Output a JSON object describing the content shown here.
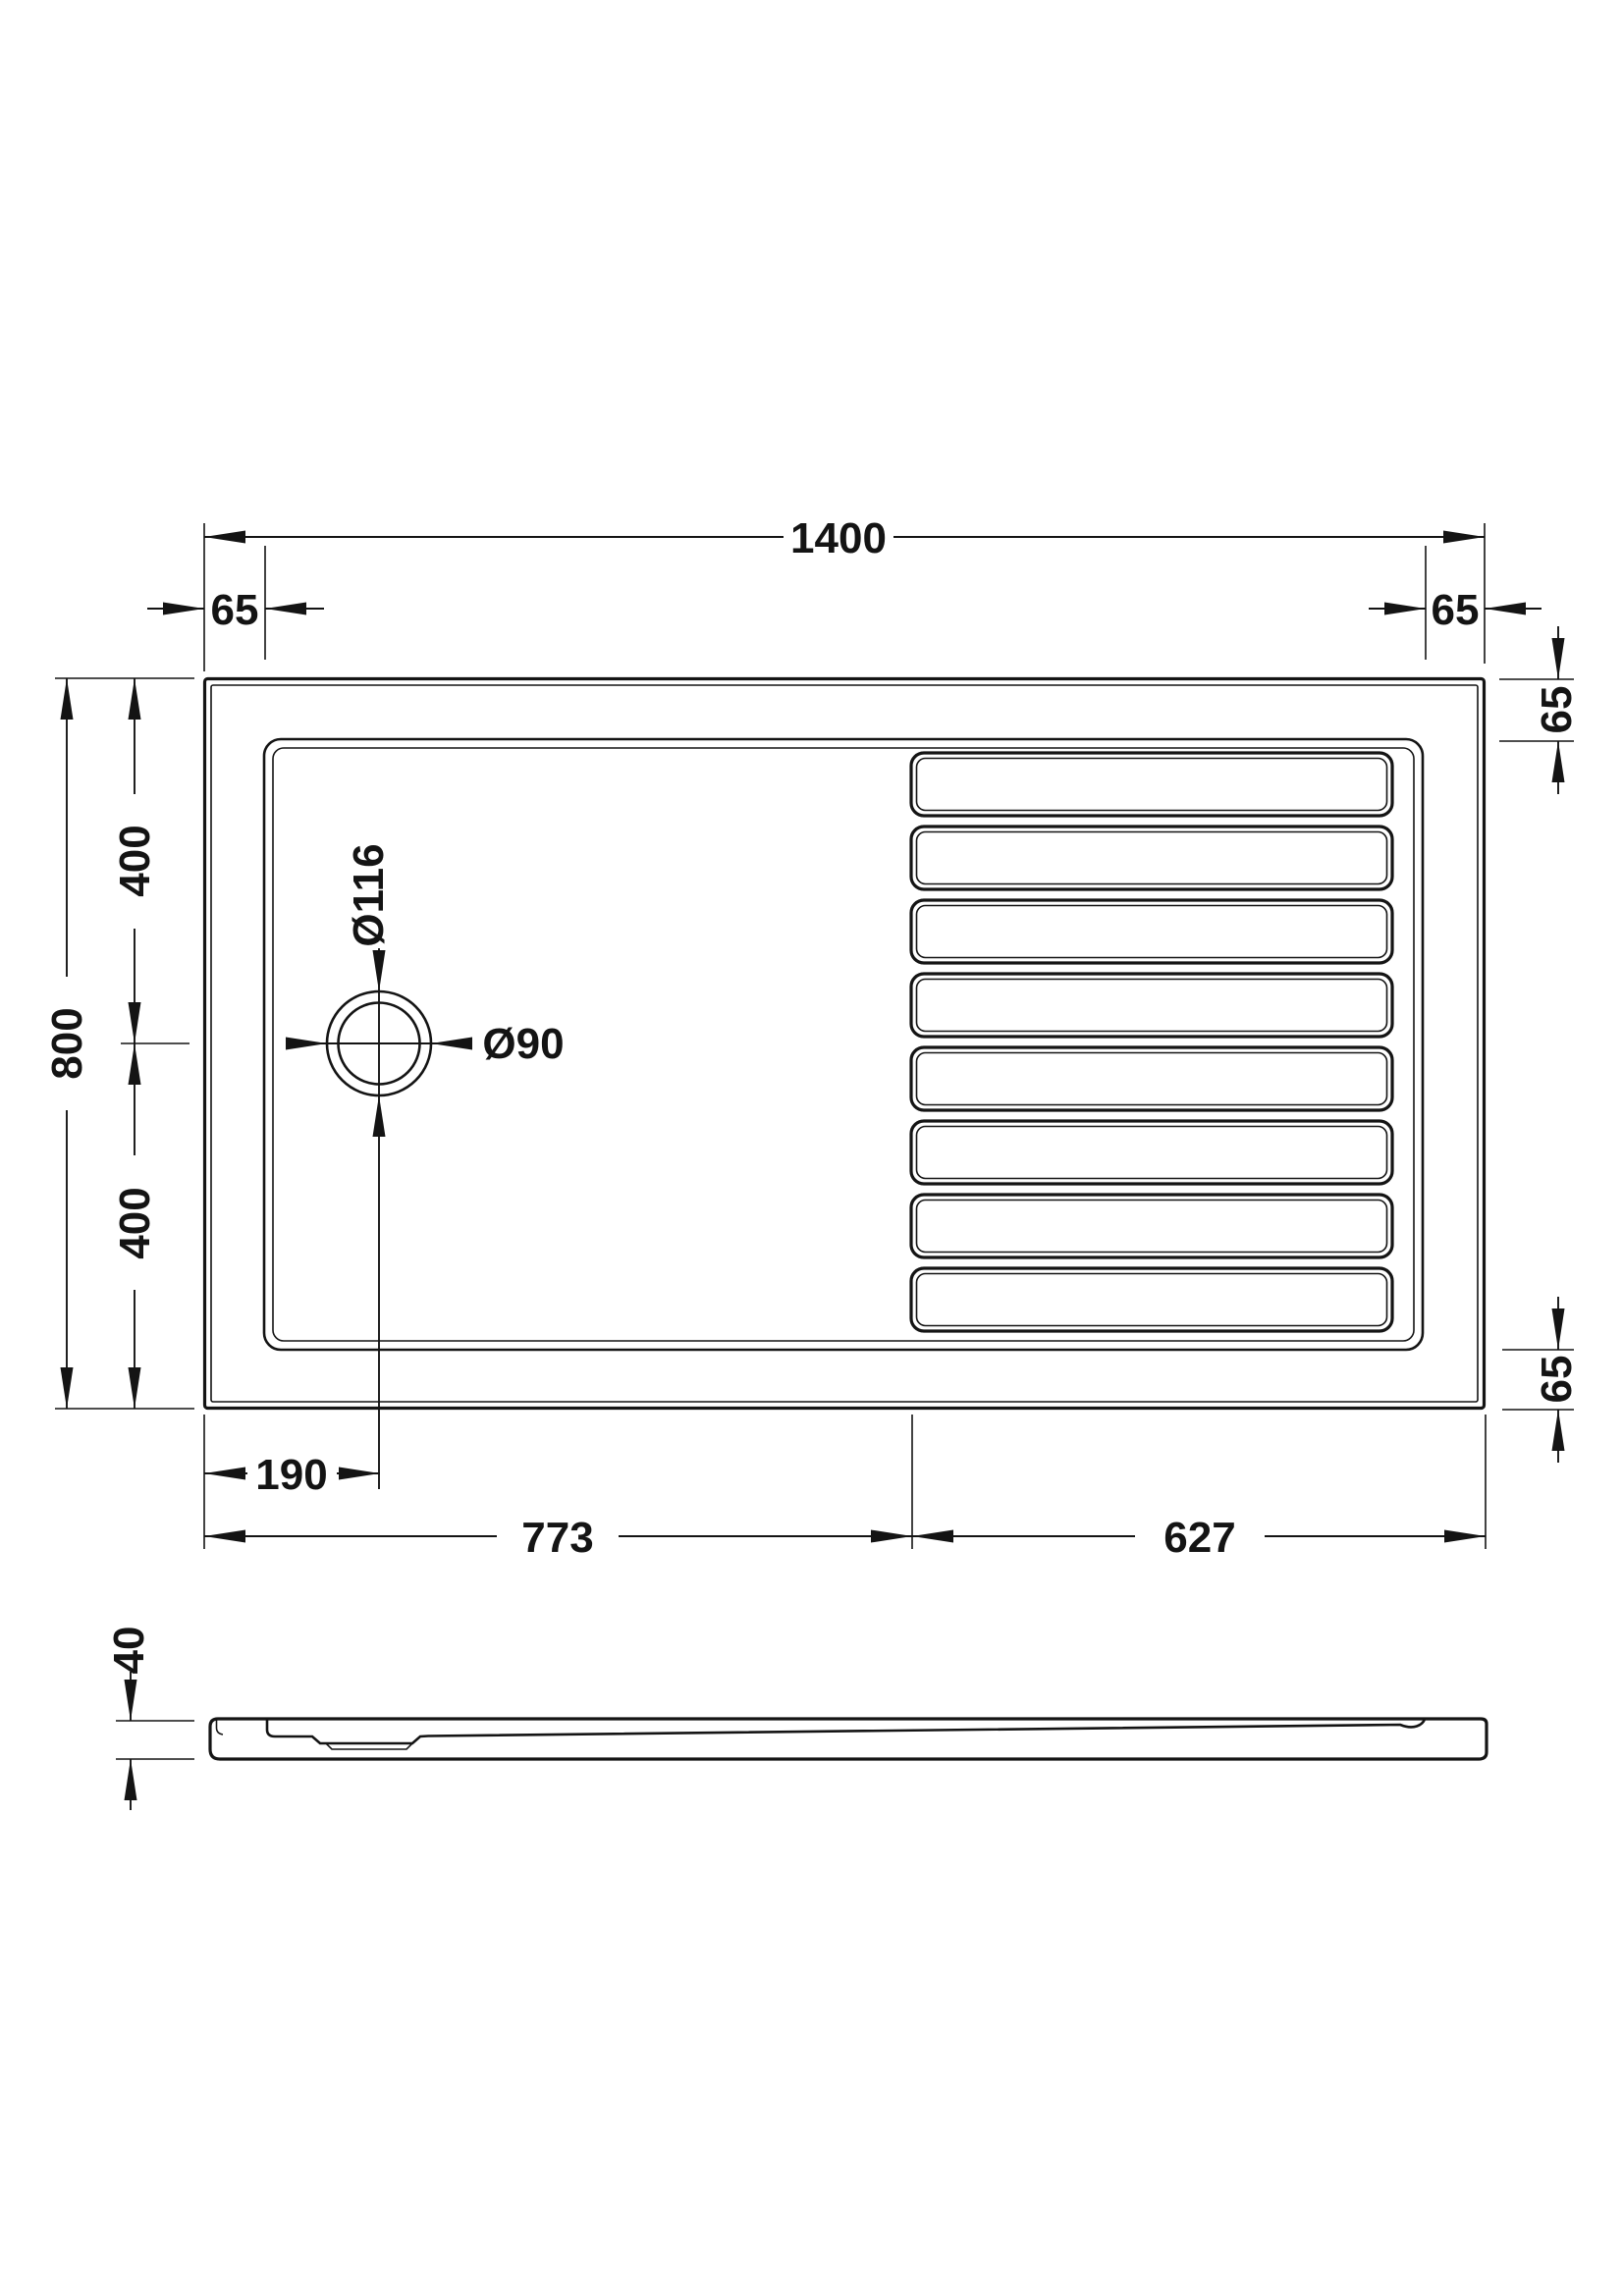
{
  "colors": {
    "background": "#ffffff",
    "line": "#141414"
  },
  "plan_view": {
    "width_label": "1400",
    "depth_label": "800",
    "depth_upper_label": "400",
    "depth_lower_label": "400",
    "rim_top_left_label": "65",
    "rim_top_right_label": "65",
    "rim_right_upper_label": "65",
    "rim_right_lower_label": "65",
    "drain_outer_diameter_label": "Ø116",
    "drain_diameter_label": "Ø90",
    "drain_offset_label": "190",
    "plain_zone_label": "773",
    "ribbed_zone_label": "627",
    "slat_count": 8
  },
  "side_view": {
    "height_label": "40"
  }
}
